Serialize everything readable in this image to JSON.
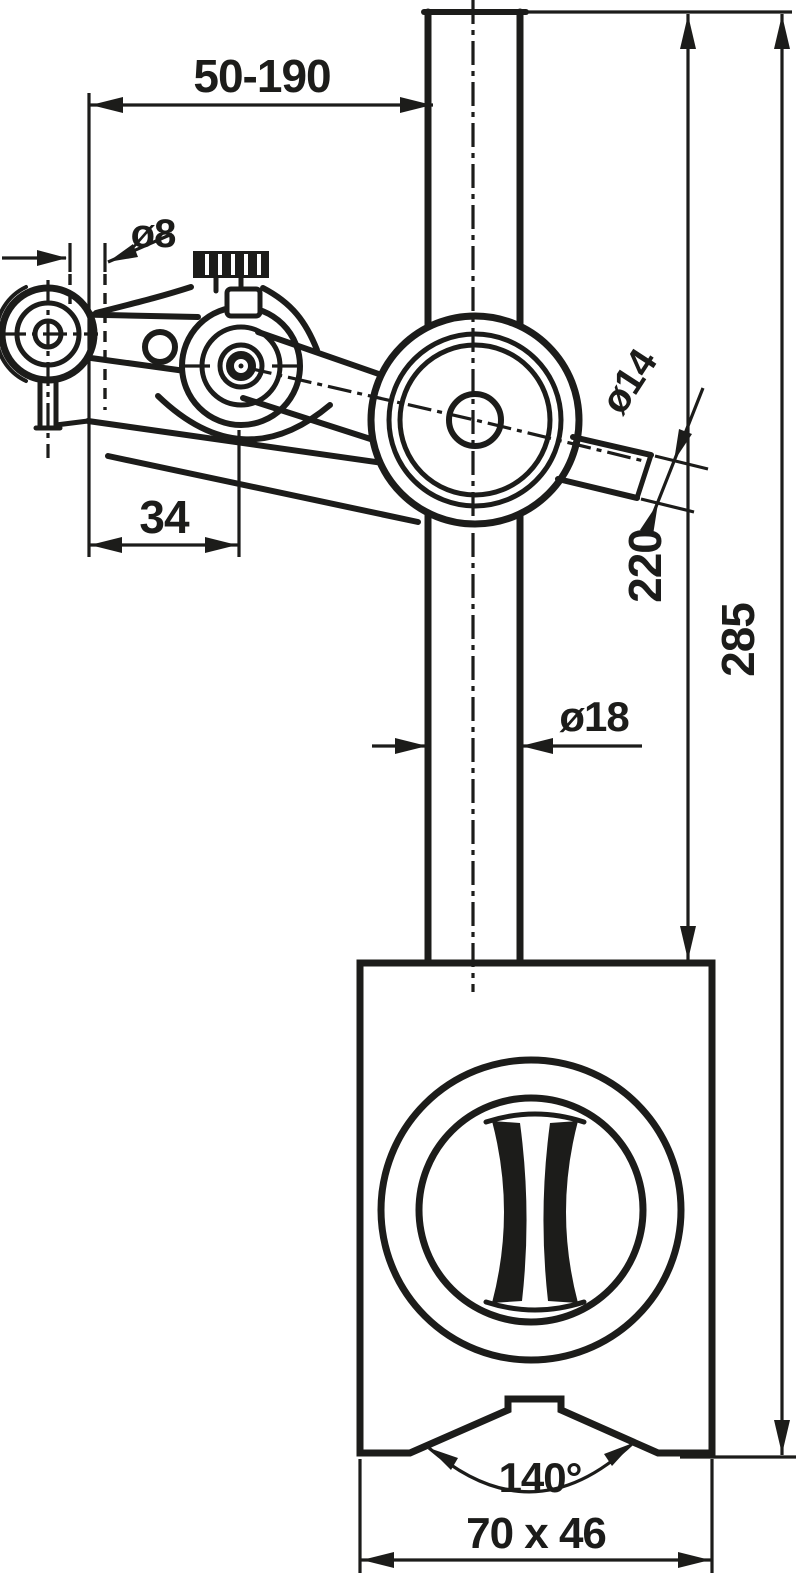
{
  "drawing": {
    "kind": "technical dimension drawing",
    "subject": "magnetic measuring stand with articulated clamp arm",
    "colors": {
      "line": "#1c1c1a",
      "background": "#ffffff"
    },
    "dimensions": {
      "reach": "50-190",
      "indicator_bore": "ø8",
      "pivot_offset": "34",
      "arm_diameter": "ø14",
      "rod_length": "220",
      "total_height": "285",
      "rod_diameter": "ø18",
      "vee_angle": "140°",
      "base_size": "70 x 46"
    }
  }
}
